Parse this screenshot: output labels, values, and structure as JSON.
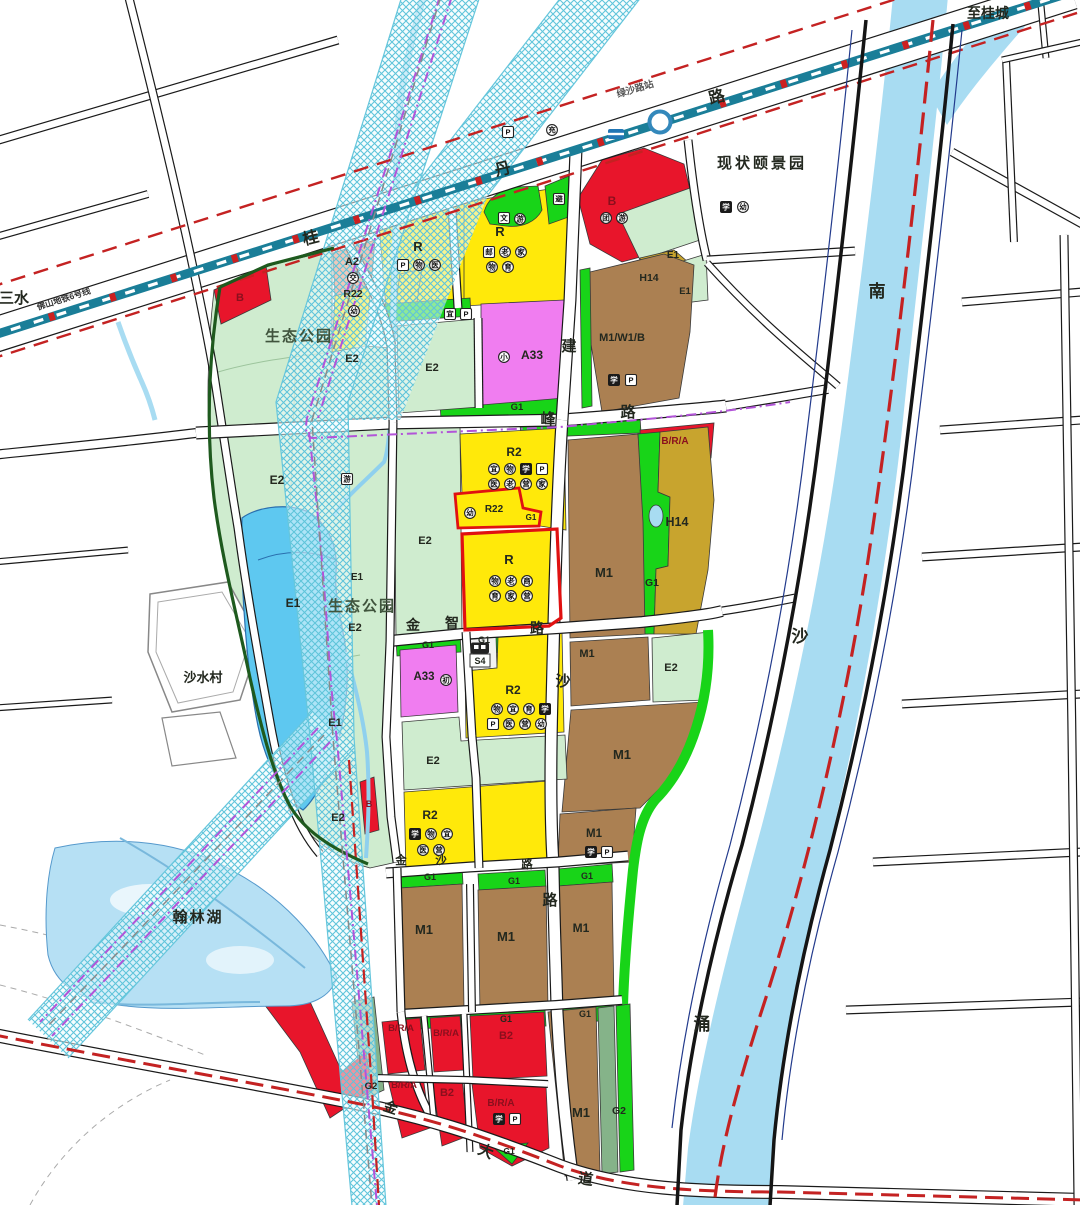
{
  "map": {
    "title": "urban land-use planning map",
    "palette": {
      "yellow": "#ffe90a",
      "paleyellow": "#ffffb3",
      "red": "#e8152b",
      "brown": "#ab8052",
      "olive": "#c8a42e",
      "magenta": "#f07df0",
      "salmon": "#ef8a68",
      "green": "#18d418",
      "sage": "#85b389",
      "park": "#cfeccf",
      "water": "#a8dcf2",
      "lake": "#5ec8f0",
      "corridor": "#5fc4da",
      "metro_teal": "#1a7e98",
      "boundary_red": "#c42222",
      "metro_purple": "#b254d8",
      "deep_blue": "#223a8c",
      "park_boundary": "#1e5a1e",
      "road_casing": "#1a1a1a",
      "zone_text": "#23281f",
      "red_zone_text": "#8a0f1d"
    },
    "labels": [
      {
        "n": "label-to-sanshui",
        "t": "至三水",
        "x": -16,
        "y": 303,
        "s": 15,
        "a": "start"
      },
      {
        "n": "label-metro-line6",
        "t": "佛山地铁6号线",
        "x": 38,
        "y": 310,
        "s": 8.5,
        "r": -17.5,
        "a": "start",
        "c": "#333333"
      },
      {
        "n": "label-lvsha-station",
        "t": "绿沙路站",
        "x": 636,
        "y": 92,
        "s": 9.5,
        "r": -17,
        "c": "#555555"
      },
      {
        "n": "label-to-guicheng",
        "t": "至桂城",
        "x": 988,
        "y": 18,
        "s": 14
      },
      {
        "n": "label-yijingyuan",
        "t": "现状颐景园",
        "x": 762,
        "y": 168,
        "s": 15,
        "ls": 3
      },
      {
        "n": "label-eco-park-1",
        "t": "生态公园",
        "x": 299,
        "y": 341,
        "s": 15,
        "ls": 2,
        "c": "#40543d"
      },
      {
        "n": "label-eco-park-2",
        "t": "生态公园",
        "x": 362,
        "y": 611,
        "s": 15,
        "ls": 2,
        "c": "#40543d"
      },
      {
        "n": "label-shashui-village",
        "t": "沙水村",
        "x": 203,
        "y": 682,
        "s": 13
      },
      {
        "n": "label-hanlin-lake",
        "t": "翰林湖",
        "x": 198,
        "y": 922,
        "s": 15,
        "ls": 2
      },
      {
        "n": "label-river-nan",
        "t": "南",
        "x": 877,
        "y": 297,
        "s": 17
      },
      {
        "n": "label-river-sha",
        "t": "沙",
        "x": 800,
        "y": 642,
        "s": 17
      },
      {
        "n": "label-river-chong",
        "t": "涌",
        "x": 702,
        "y": 1030,
        "s": 17
      },
      {
        "n": "road-char",
        "t": "桂",
        "x": 312,
        "y": 243,
        "s": 16,
        "r": -14
      },
      {
        "n": "road-char",
        "t": "丹",
        "x": 504,
        "y": 174,
        "s": 16,
        "r": -14
      },
      {
        "n": "road-char",
        "t": "路",
        "x": 718,
        "y": 102,
        "s": 16,
        "r": -14
      },
      {
        "n": "road-char",
        "t": "建",
        "x": 569,
        "y": 351,
        "s": 15
      },
      {
        "n": "road-char",
        "t": "峰",
        "x": 548,
        "y": 424,
        "s": 15
      },
      {
        "n": "road-char",
        "t": "路",
        "x": 628,
        "y": 417,
        "s": 15
      },
      {
        "n": "road-char",
        "t": "金",
        "x": 413,
        "y": 630,
        "s": 14
      },
      {
        "n": "road-char",
        "t": "智",
        "x": 452,
        "y": 628,
        "s": 14
      },
      {
        "n": "road-char",
        "t": "路",
        "x": 537,
        "y": 633,
        "s": 14
      },
      {
        "n": "road-char",
        "t": "沙",
        "x": 563,
        "y": 686,
        "s": 15
      },
      {
        "n": "road-char",
        "t": "路",
        "x": 550,
        "y": 905,
        "s": 15
      },
      {
        "n": "road-char",
        "t": "金",
        "x": 401,
        "y": 864,
        "s": 11.5
      },
      {
        "n": "road-char",
        "t": "沙",
        "x": 441,
        "y": 864,
        "s": 11.5
      },
      {
        "n": "road-char",
        "t": "路",
        "x": 527,
        "y": 868,
        "s": 11.5
      },
      {
        "n": "road-char",
        "t": "金",
        "x": 389,
        "y": 1112,
        "s": 14,
        "r": 18
      },
      {
        "n": "road-char",
        "t": "大",
        "x": 484,
        "y": 1156,
        "s": 15,
        "r": 22
      },
      {
        "n": "road-char",
        "t": "道",
        "x": 585,
        "y": 1184,
        "s": 15,
        "r": 8
      },
      {
        "n": "zone-label",
        "t": "B",
        "x": 240,
        "y": 301,
        "s": 11,
        "c": "red"
      },
      {
        "n": "zone-label",
        "t": "A2",
        "x": 352,
        "y": 265,
        "s": 11
      },
      {
        "n": "zone-label",
        "t": "R22",
        "x": 353,
        "y": 297,
        "s": 10.5
      },
      {
        "n": "zone-label",
        "t": "R",
        "x": 418,
        "y": 251,
        "s": 13
      },
      {
        "n": "zone-label",
        "t": "R",
        "x": 500,
        "y": 236,
        "s": 13
      },
      {
        "n": "zone-label",
        "t": "B",
        "x": 612,
        "y": 205,
        "s": 12,
        "c": "red"
      },
      {
        "n": "zone-label",
        "t": "E1",
        "x": 673,
        "y": 258,
        "s": 10
      },
      {
        "n": "zone-label",
        "t": "H14",
        "x": 649,
        "y": 281,
        "s": 10.5
      },
      {
        "n": "zone-label",
        "t": "E1",
        "x": 685,
        "y": 294,
        "s": 9.5
      },
      {
        "n": "zone-label",
        "t": "M1/W1/B",
        "x": 622,
        "y": 341,
        "s": 11
      },
      {
        "n": "zone-label",
        "t": "A33",
        "x": 532,
        "y": 359,
        "s": 12
      },
      {
        "n": "zone-label",
        "t": "E2",
        "x": 352,
        "y": 362,
        "s": 11
      },
      {
        "n": "zone-label",
        "t": "E2",
        "x": 432,
        "y": 371,
        "s": 11
      },
      {
        "n": "zone-label",
        "t": "G1",
        "x": 517,
        "y": 410,
        "s": 9.5
      },
      {
        "n": "zone-label",
        "t": "B/R/A",
        "x": 675,
        "y": 444,
        "s": 10,
        "c": "red"
      },
      {
        "n": "zone-label",
        "t": "R2",
        "x": 514,
        "y": 456,
        "s": 12
      },
      {
        "n": "zone-label",
        "t": "E2",
        "x": 277,
        "y": 484,
        "s": 12
      },
      {
        "n": "zone-label",
        "t": "E2",
        "x": 425,
        "y": 544,
        "s": 11
      },
      {
        "n": "zone-label",
        "t": "R22",
        "x": 494,
        "y": 512,
        "s": 10
      },
      {
        "n": "zone-label",
        "t": "G1",
        "x": 531,
        "y": 520,
        "s": 8
      },
      {
        "n": "zone-label",
        "t": "R",
        "x": 509,
        "y": 564,
        "s": 13
      },
      {
        "n": "zone-label",
        "t": "M1",
        "x": 604,
        "y": 577,
        "s": 13
      },
      {
        "n": "zone-label",
        "t": "H14",
        "x": 677,
        "y": 526,
        "s": 12.5
      },
      {
        "n": "zone-label",
        "t": "G1",
        "x": 652,
        "y": 586,
        "s": 10.5
      },
      {
        "n": "zone-label",
        "t": "E1",
        "x": 293,
        "y": 607,
        "s": 12
      },
      {
        "n": "zone-label",
        "t": "E1",
        "x": 357,
        "y": 580,
        "s": 10
      },
      {
        "n": "zone-label",
        "t": "E2",
        "x": 355,
        "y": 631,
        "s": 11
      },
      {
        "n": "zone-label",
        "t": "G1",
        "x": 428,
        "y": 648,
        "s": 9
      },
      {
        "n": "zone-label",
        "t": "G1",
        "x": 484,
        "y": 643,
        "s": 9
      },
      {
        "n": "zone-label",
        "t": "A33",
        "x": 424,
        "y": 680,
        "s": 11.5
      },
      {
        "n": "zone-label",
        "t": "S4",
        "x": 480,
        "y": 664,
        "s": 9
      },
      {
        "n": "zone-label",
        "t": "R2",
        "x": 513,
        "y": 694,
        "s": 12
      },
      {
        "n": "zone-label",
        "t": "M1",
        "x": 587,
        "y": 657,
        "s": 11
      },
      {
        "n": "zone-label",
        "t": "E2",
        "x": 671,
        "y": 671,
        "s": 11
      },
      {
        "n": "zone-label",
        "t": "M1",
        "x": 622,
        "y": 759,
        "s": 13
      },
      {
        "n": "zone-label",
        "t": "E1",
        "x": 335,
        "y": 726,
        "s": 11
      },
      {
        "n": "zone-label",
        "t": "E2",
        "x": 338,
        "y": 821,
        "s": 11
      },
      {
        "n": "zone-label",
        "t": "B",
        "x": 369,
        "y": 807,
        "s": 9,
        "c": "red"
      },
      {
        "n": "zone-label",
        "t": "R2",
        "x": 430,
        "y": 819,
        "s": 12
      },
      {
        "n": "zone-label",
        "t": "M1",
        "x": 594,
        "y": 837,
        "s": 11.5
      },
      {
        "n": "zone-label",
        "t": "E2",
        "x": 433,
        "y": 764,
        "s": 11
      },
      {
        "n": "zone-label",
        "t": "G1",
        "x": 430,
        "y": 880,
        "s": 9
      },
      {
        "n": "zone-label",
        "t": "G1",
        "x": 514,
        "y": 884,
        "s": 9
      },
      {
        "n": "zone-label",
        "t": "G1",
        "x": 587,
        "y": 879,
        "s": 9
      },
      {
        "n": "zone-label",
        "t": "M1",
        "x": 424,
        "y": 934,
        "s": 13
      },
      {
        "n": "zone-label",
        "t": "M1",
        "x": 506,
        "y": 941,
        "s": 13
      },
      {
        "n": "zone-label",
        "t": "M1",
        "x": 581,
        "y": 932,
        "s": 12
      },
      {
        "n": "zone-label",
        "t": "G1",
        "x": 506,
        "y": 1022,
        "s": 9
      },
      {
        "n": "zone-label",
        "t": "G1",
        "x": 585,
        "y": 1017,
        "s": 9
      },
      {
        "n": "zone-label",
        "t": "B/R/A",
        "x": 401,
        "y": 1031,
        "s": 9.5,
        "c": "red"
      },
      {
        "n": "zone-label",
        "t": "B/R/A",
        "x": 446,
        "y": 1036,
        "s": 9.5,
        "c": "red"
      },
      {
        "n": "zone-label",
        "t": "B2",
        "x": 506,
        "y": 1039,
        "s": 11,
        "c": "red"
      },
      {
        "n": "zone-label",
        "t": "G2",
        "x": 371,
        "y": 1089,
        "s": 9.5
      },
      {
        "n": "zone-label",
        "t": "B/R/A",
        "x": 404,
        "y": 1088,
        "s": 9.5,
        "c": "red"
      },
      {
        "n": "zone-label",
        "t": "B2",
        "x": 447,
        "y": 1096,
        "s": 11,
        "c": "red"
      },
      {
        "n": "zone-label",
        "t": "B/R/A",
        "x": 501,
        "y": 1106,
        "s": 10,
        "c": "red"
      },
      {
        "n": "zone-label",
        "t": "G1",
        "x": 509,
        "y": 1154,
        "s": 8.5
      },
      {
        "n": "zone-label",
        "t": "M1",
        "x": 581,
        "y": 1117,
        "s": 13
      },
      {
        "n": "zone-label",
        "t": "G2",
        "x": 619,
        "y": 1114,
        "s": 10.5
      }
    ],
    "icons": [
      {
        "k": "box",
        "g": "P",
        "x": 508,
        "y": 132
      },
      {
        "k": "circle",
        "g": "充",
        "x": 552,
        "y": 130
      },
      {
        "k": "metro",
        "x": 616,
        "y": 134
      },
      {
        "k": "dark",
        "g": "学",
        "x": 726,
        "y": 207
      },
      {
        "k": "circle",
        "g": "幼",
        "x": 743,
        "y": 207
      },
      {
        "k": "circle",
        "g": "交",
        "x": 353,
        "y": 278
      },
      {
        "k": "circle",
        "g": "幼",
        "x": 354,
        "y": 311
      },
      {
        "k": "box",
        "g": "P",
        "x": 403,
        "y": 265
      },
      {
        "k": "circle",
        "g": "物",
        "x": 419,
        "y": 265
      },
      {
        "k": "circle",
        "g": "医",
        "x": 435,
        "y": 265
      },
      {
        "k": "box",
        "g": "邮",
        "x": 489,
        "y": 252
      },
      {
        "k": "circle",
        "g": "老",
        "x": 505,
        "y": 252
      },
      {
        "k": "circle",
        "g": "家",
        "x": 521,
        "y": 252
      },
      {
        "k": "circle",
        "g": "物",
        "x": 492,
        "y": 267
      },
      {
        "k": "circle",
        "g": "育",
        "x": 508,
        "y": 267
      },
      {
        "k": "box",
        "g": "文",
        "x": 504,
        "y": 218
      },
      {
        "k": "circle",
        "g": "游",
        "x": 520,
        "y": 219
      },
      {
        "k": "box",
        "g": "避",
        "x": 559,
        "y": 199
      },
      {
        "k": "circle",
        "g": "团",
        "x": 606,
        "y": 218
      },
      {
        "k": "circle",
        "g": "游",
        "x": 622,
        "y": 218
      },
      {
        "k": "dark",
        "g": "学",
        "x": 614,
        "y": 380
      },
      {
        "k": "box",
        "g": "P",
        "x": 631,
        "y": 380
      },
      {
        "k": "box",
        "g": "宜",
        "x": 450,
        "y": 314
      },
      {
        "k": "box",
        "g": "P",
        "x": 466,
        "y": 314
      },
      {
        "k": "circle",
        "g": "小",
        "x": 504,
        "y": 357
      },
      {
        "k": "circle",
        "g": "初",
        "x": 446,
        "y": 680
      },
      {
        "k": "circle",
        "g": "宜",
        "x": 494,
        "y": 469
      },
      {
        "k": "circle",
        "g": "物",
        "x": 510,
        "y": 469
      },
      {
        "k": "dark",
        "g": "学",
        "x": 526,
        "y": 469
      },
      {
        "k": "box",
        "g": "P",
        "x": 542,
        "y": 469
      },
      {
        "k": "circle",
        "g": "医",
        "x": 494,
        "y": 484
      },
      {
        "k": "circle",
        "g": "老",
        "x": 510,
        "y": 484
      },
      {
        "k": "circle",
        "g": "营",
        "x": 526,
        "y": 484
      },
      {
        "k": "circle",
        "g": "家",
        "x": 542,
        "y": 484
      },
      {
        "k": "circle",
        "g": "幼",
        "x": 470,
        "y": 513
      },
      {
        "k": "circle",
        "g": "物",
        "x": 495,
        "y": 581
      },
      {
        "k": "circle",
        "g": "老",
        "x": 511,
        "y": 581
      },
      {
        "k": "circle",
        "g": "商",
        "x": 527,
        "y": 581
      },
      {
        "k": "circle",
        "g": "育",
        "x": 495,
        "y": 596
      },
      {
        "k": "circle",
        "g": "家",
        "x": 511,
        "y": 596
      },
      {
        "k": "circle",
        "g": "营",
        "x": 527,
        "y": 596
      },
      {
        "k": "bus",
        "x": 480,
        "y": 648
      },
      {
        "k": "circle",
        "g": "物",
        "x": 497,
        "y": 709
      },
      {
        "k": "circle",
        "g": "宜",
        "x": 513,
        "y": 709
      },
      {
        "k": "circle",
        "g": "育",
        "x": 529,
        "y": 709
      },
      {
        "k": "dark",
        "g": "学",
        "x": 545,
        "y": 709
      },
      {
        "k": "box",
        "g": "P",
        "x": 493,
        "y": 724
      },
      {
        "k": "circle",
        "g": "医",
        "x": 509,
        "y": 724
      },
      {
        "k": "circle",
        "g": "营",
        "x": 525,
        "y": 724
      },
      {
        "k": "circle",
        "g": "幼",
        "x": 541,
        "y": 724
      },
      {
        "k": "dark",
        "g": "学",
        "x": 415,
        "y": 834
      },
      {
        "k": "circle",
        "g": "物",
        "x": 431,
        "y": 834
      },
      {
        "k": "circle",
        "g": "宜",
        "x": 447,
        "y": 834
      },
      {
        "k": "circle",
        "g": "医",
        "x": 423,
        "y": 850
      },
      {
        "k": "circle",
        "g": "营",
        "x": 439,
        "y": 850
      },
      {
        "k": "dark",
        "g": "学",
        "x": 591,
        "y": 852
      },
      {
        "k": "box",
        "g": "P",
        "x": 607,
        "y": 852
      },
      {
        "k": "dark",
        "g": "学",
        "x": 499,
        "y": 1119
      },
      {
        "k": "box",
        "g": "P",
        "x": 515,
        "y": 1119
      },
      {
        "k": "box",
        "g": "游",
        "x": 347,
        "y": 479
      }
    ]
  }
}
